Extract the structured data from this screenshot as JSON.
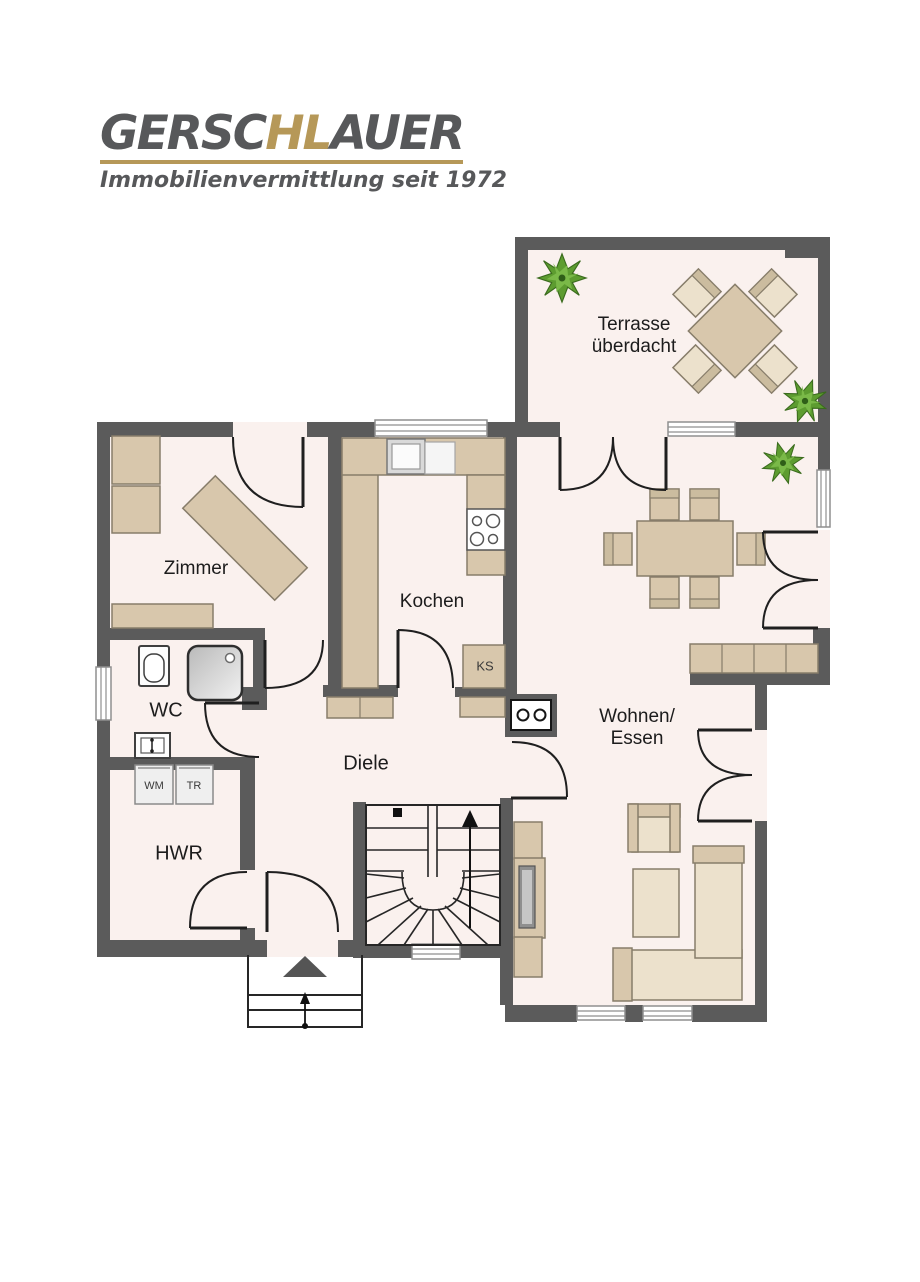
{
  "brand": {
    "name_part1": "GERSC",
    "name_part2": "HL",
    "name_part3": "AUER",
    "tagline": "Immobilienvermittlung seit 1972"
  },
  "rooms": {
    "terrace_line1": "Terrasse",
    "terrace_line2": "überdacht",
    "zimmer": "Zimmer",
    "kochen": "Kochen",
    "ks": "KS",
    "wc": "WC",
    "wm": "WM",
    "tr": "TR",
    "hwr": "HWR",
    "diele": "Diele",
    "wohnen_line1": "Wohnen/",
    "wohnen_line2": "Essen"
  },
  "colors": {
    "wall": "#5b5b5b",
    "floor": "#faf1ee",
    "tan": "#d8c7ac",
    "tanlight": "#ece1cc",
    "gray": "#57585a",
    "gold": "#b69858",
    "green1": "#5d9c30",
    "green2": "#7ab948"
  }
}
